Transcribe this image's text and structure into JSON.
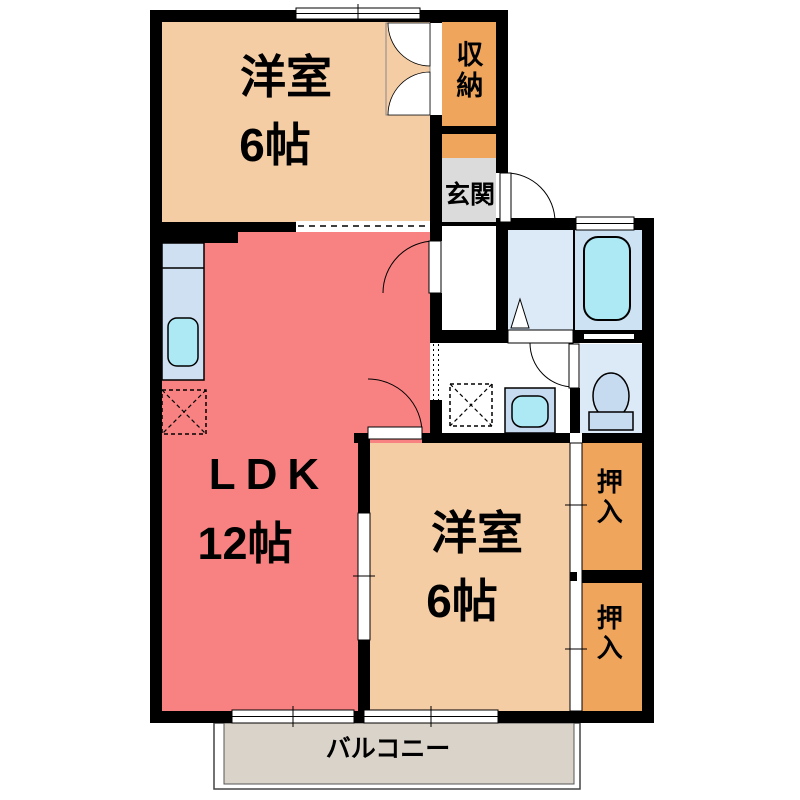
{
  "plan": {
    "bedroom_top": {
      "label": "洋室",
      "area": "6帖"
    },
    "ldk": {
      "label": "LDK",
      "area": "12帖"
    },
    "bedroom_bottom": {
      "label": "洋室",
      "area": "6帖"
    },
    "storage": {
      "label": "収納"
    },
    "entrance": {
      "label": "玄関"
    },
    "closet_upper": {
      "label": "押入"
    },
    "closet_lower": {
      "label": "押入"
    },
    "balcony": {
      "label": "バルコニー"
    }
  },
  "colors": {
    "wall": "#000000",
    "bedroom": "#f5cda4",
    "ldk": "#f88282",
    "closet": "#efa55c",
    "entrance_floor": "#dbdbdb",
    "washroom": "#dceaf7",
    "bathroom": "#cde3f3",
    "fixture_cyan": "#ade9f4",
    "fixture_blue": "#c6daf0",
    "kitchen_counter": "#cee0f2",
    "balcony_floor": "#dad3c9"
  }
}
